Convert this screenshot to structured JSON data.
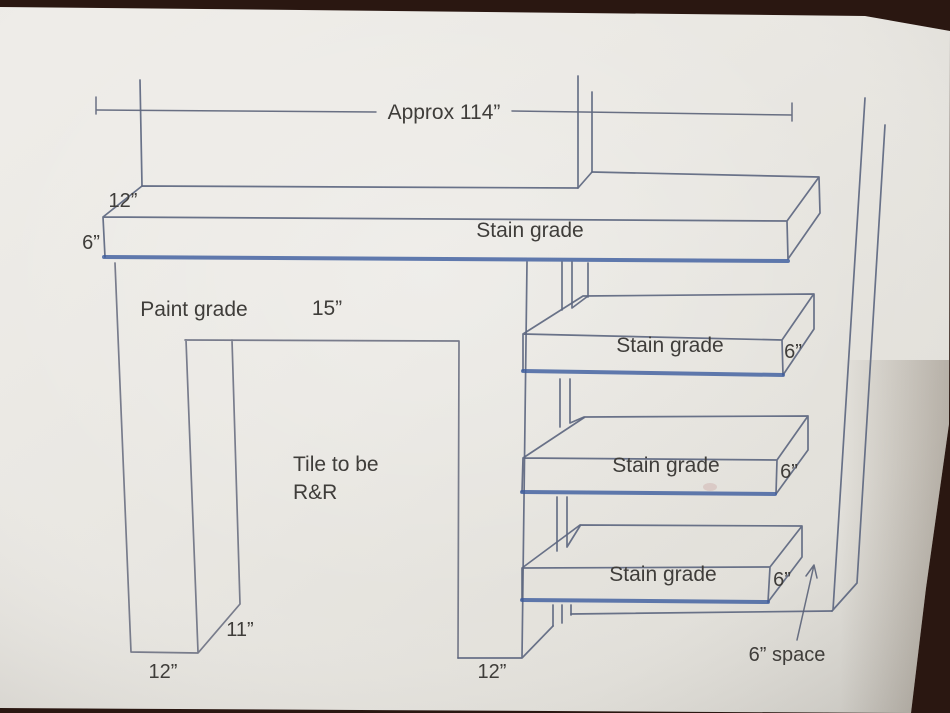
{
  "scene": {
    "description": "Photograph of a printed fireplace / mantel shelving sketch lying on a dark brown surface",
    "surface_color": "#2a1711",
    "paper_color": "#e9e7e2",
    "line_color": "#5d6780",
    "accent_line_color": "#3b5b9e",
    "text_color": "#3f3d3a"
  },
  "labels": {
    "overall_width": "Approx 114”",
    "mantel_depth": "12”",
    "mantel_thickness": "6”",
    "mantel_material": "Stain grade",
    "leg_material": "Paint grade",
    "leg_width": "15”",
    "tile_note_line1": "Tile to be",
    "tile_note_line2": "R&R",
    "leg_side_depth": "11”",
    "left_leg_bottom_width": "12”",
    "right_leg_bottom_width": "12”",
    "wall_gap": "6” space"
  },
  "shelves": [
    {
      "material": "Stain grade",
      "thickness": "6”"
    },
    {
      "material": "Stain grade",
      "thickness": "6”"
    },
    {
      "material": "Stain grade",
      "thickness": "6”"
    }
  ]
}
